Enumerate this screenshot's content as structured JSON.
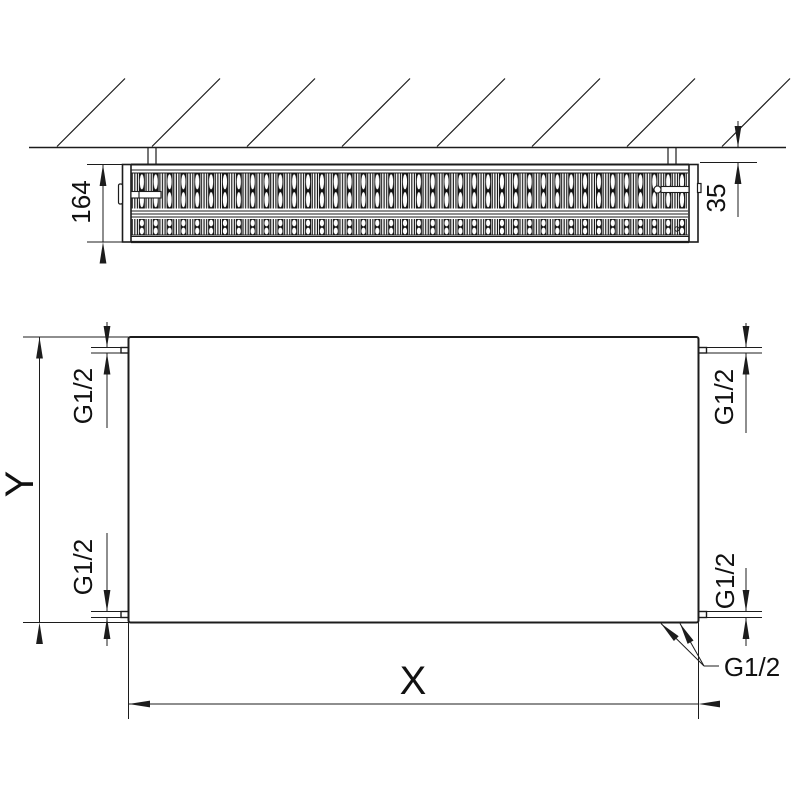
{
  "colors": {
    "line": "#1c1c1c",
    "text": "#111111",
    "background": "#ffffff"
  },
  "top_view": {
    "depth_dim": "164",
    "wall_gap_dim": "35"
  },
  "front_view": {
    "height_dim": "Y",
    "width_dim": "X",
    "conn_top_left": "G1/2",
    "conn_bottom_left": "G1/2",
    "conn_top_right": "G1/2",
    "conn_bottom_right": "G1/2",
    "conn_bottom_center": "G1/2"
  }
}
